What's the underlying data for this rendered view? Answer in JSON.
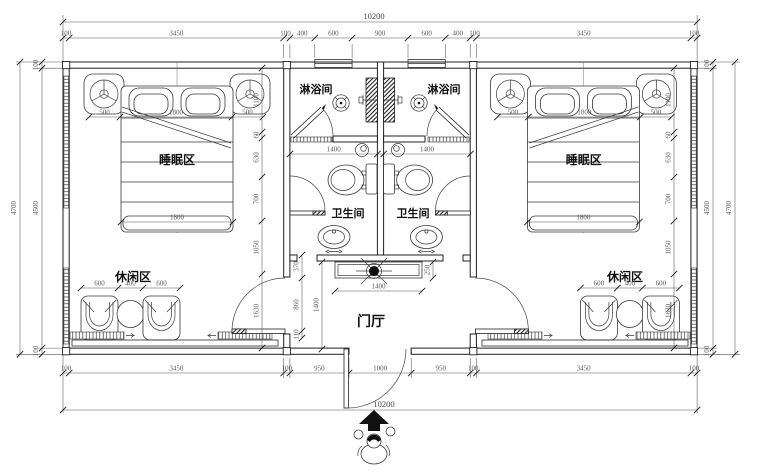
{
  "labels": {
    "shower_left": "淋浴间",
    "shower_right": "淋浴间",
    "sleep_left": "睡眠区",
    "sleep_right": "睡眠区",
    "bath_left": "卫生间",
    "bath_right": "卫生间",
    "leisure_left": "休闲区",
    "leisure_right": "休闲区",
    "foyer": "门厅"
  },
  "dims": {
    "top_overall": "10200",
    "bottom_overall": "10200",
    "top_chain": [
      "100",
      "3450",
      "100",
      "400",
      "600",
      "900",
      "600",
      "400",
      "100",
      "3450",
      "100"
    ],
    "bottom_chain": [
      "100",
      "3450",
      "100",
      "950",
      "1000",
      "950",
      "100",
      "3450",
      "100"
    ],
    "side_outer": "4700",
    "side_inner": "4500",
    "side_wall": "100",
    "room_chain": [
      "1100",
      "60",
      "630",
      "700",
      "1050",
      "1630"
    ],
    "bed_side": "500",
    "bed_width": "1800",
    "chair_width": "600",
    "table_gap": "400",
    "shower_width": "1400",
    "cabinet_width": "1400",
    "cabinet_depth": "250",
    "foyer_height": "1400",
    "foyer_chain": [
      "370",
      "860",
      "110"
    ]
  },
  "colors": {
    "line": "#222222",
    "dim_text": "#5a5a5a",
    "background": "#ffffff"
  }
}
